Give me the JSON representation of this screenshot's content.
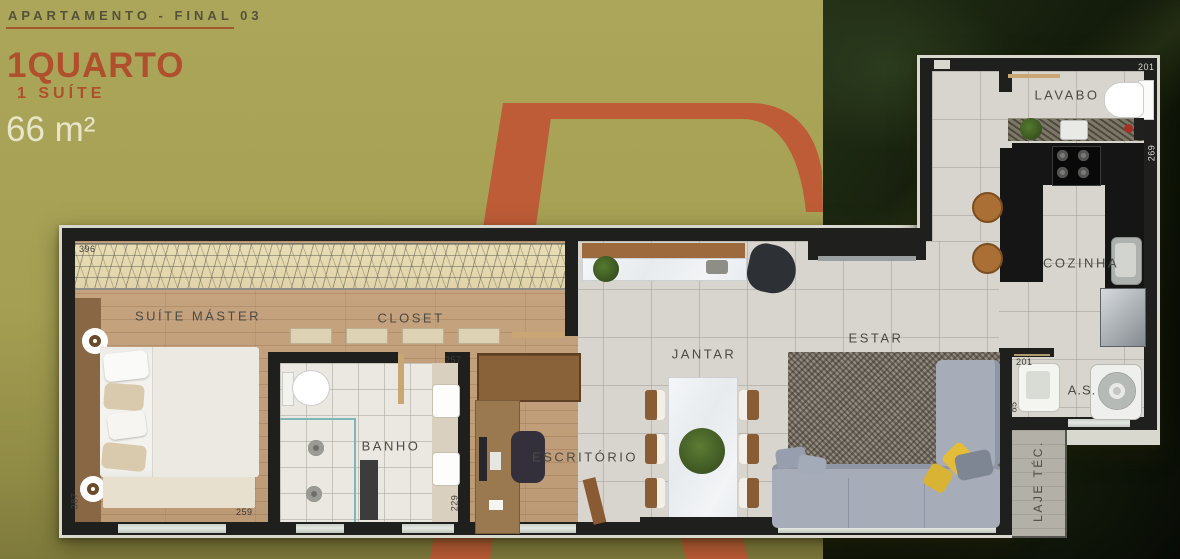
{
  "header": {
    "title": "APARTAMENTO - FINAL 03",
    "headline": "1QUARTO",
    "subheadline": "1 SUÍTE",
    "area": "66 m²"
  },
  "rooms": {
    "suite": "SUÍTE MÁSTER",
    "closet": "CLOSET",
    "banho": "BANHO",
    "escritorio": "ESCRITÓRIO",
    "jantar": "JANTAR",
    "estar": "ESTAR",
    "lavabo": "LAVABO",
    "cozinha": "COZINHA",
    "servico": "A.S.",
    "laje": "LAJE TÉC."
  },
  "dimensions": {
    "suite_width": "396",
    "suite_bottom": "259",
    "suite_side": "387",
    "banho_width": "257",
    "banho_side": "229",
    "lavabo_width": "201",
    "cozinha_side": "269",
    "servico_width": "201",
    "servico_side": "85"
  },
  "colors": {
    "olive_background": "#a9a355",
    "rust_accent": "#b04f2c",
    "cream": "#e9e5c8",
    "wall": "#1f1f1d",
    "floor_gray": "#d7d5cd",
    "floor_wood": "#c2a17d"
  }
}
